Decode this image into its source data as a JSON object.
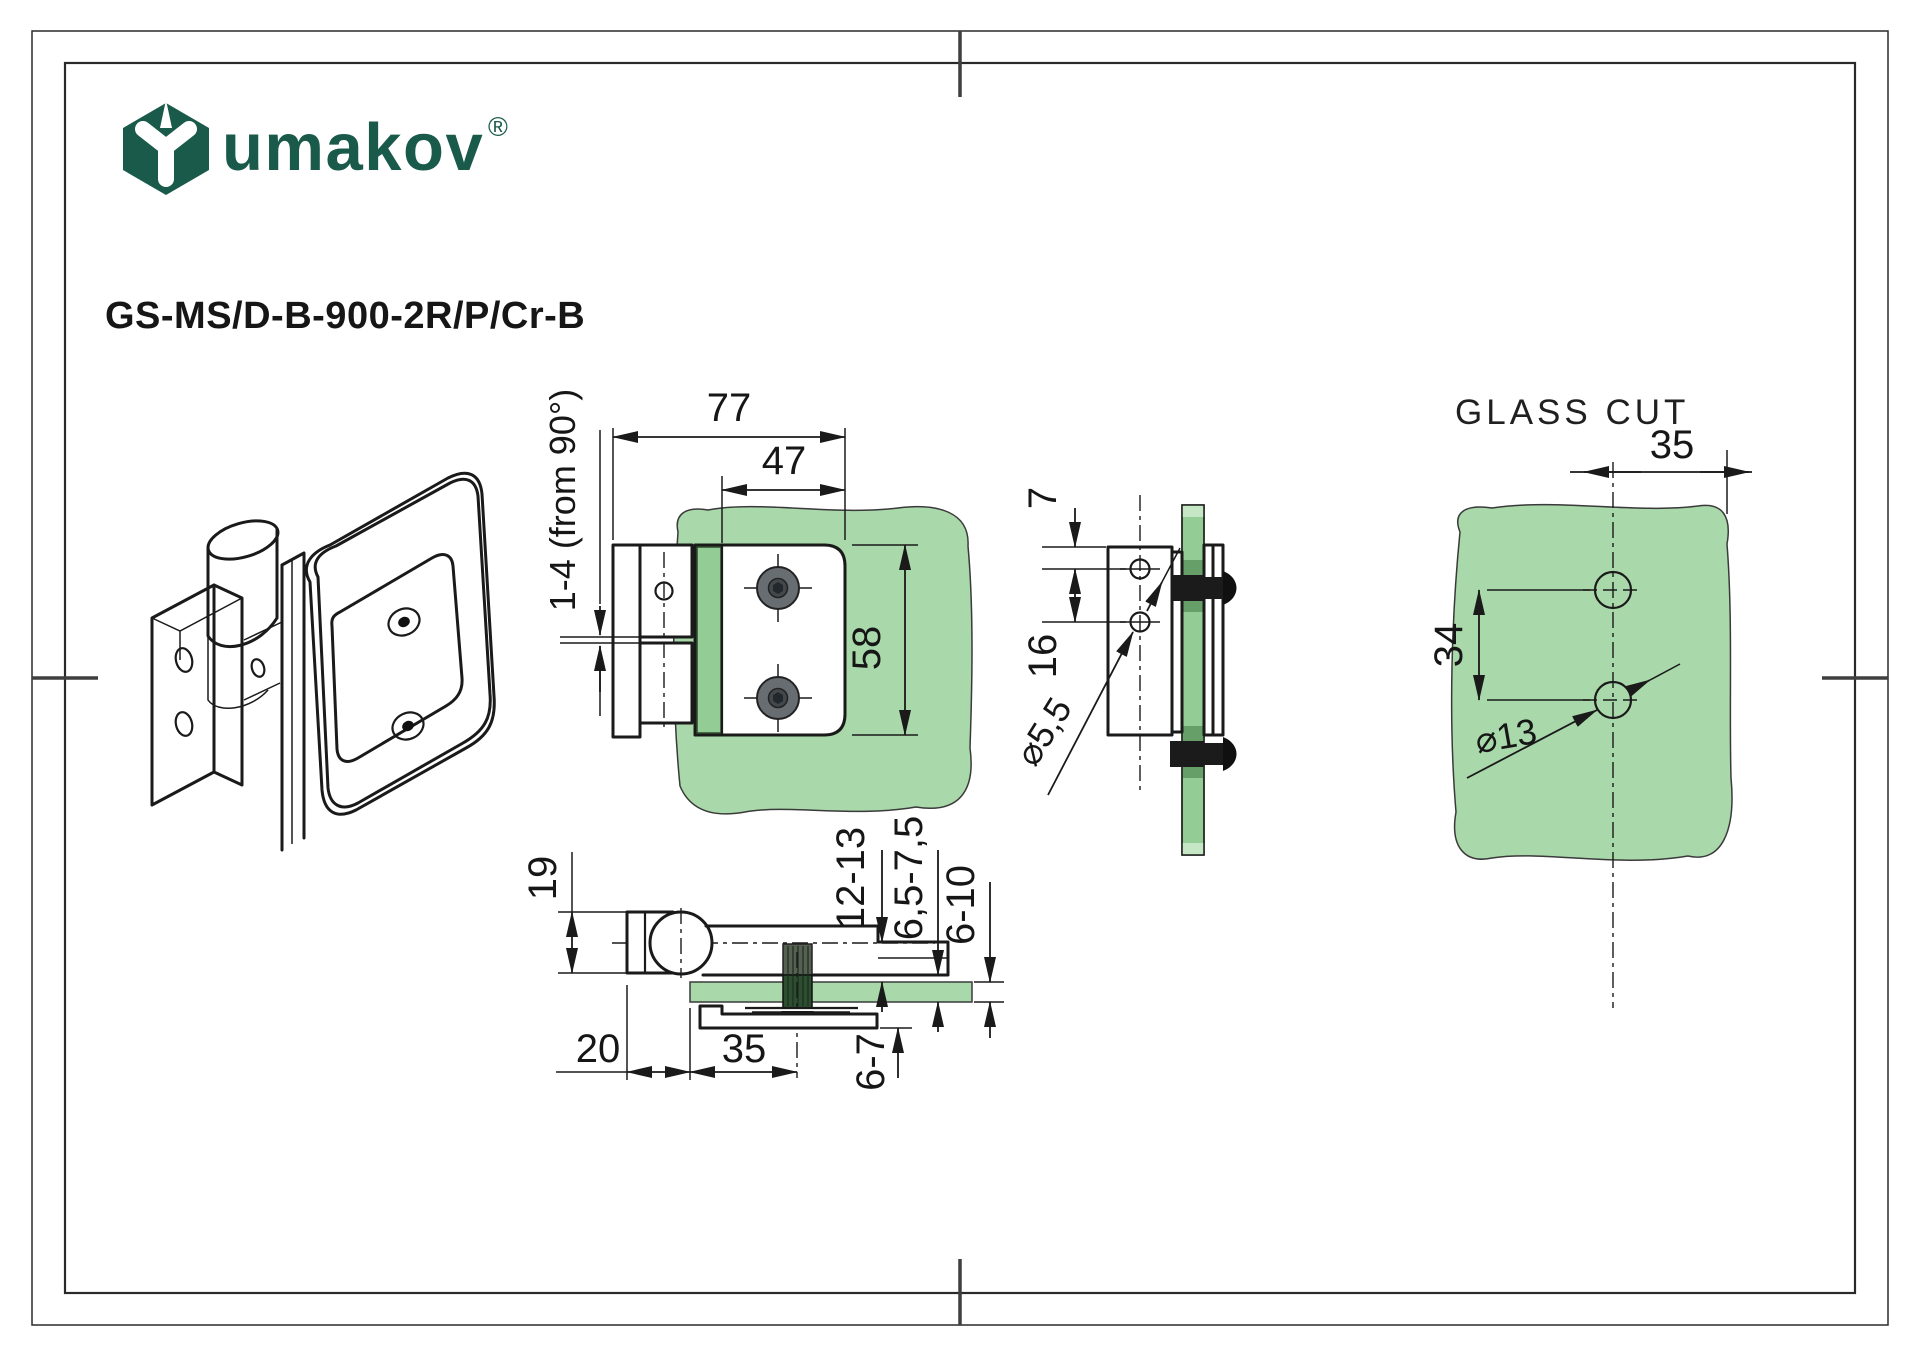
{
  "document": {
    "kind": "technical-drawing-sheet",
    "product": "glass door hinge"
  },
  "logo": {
    "icon": "umakov-hexagon-star-logo-icon",
    "brand": "umakov",
    "registered": "®"
  },
  "part_number": "GS-MS/D-B-900-2R/P/Cr-B",
  "views": {
    "front": {
      "dim_total_width": "77",
      "dim_plate_width": "47",
      "dim_height": "58",
      "dim_adjustment": "1-4 (from 90°)"
    },
    "side": {
      "dim_top_offset": "7",
      "dim_hole_spacing": "16",
      "dim_hole_diameter": "⌀5,5"
    },
    "bottom": {
      "dim_knuckle": "19",
      "dim_hinge_offset": "20",
      "dim_screw_offset": "35",
      "dim_clamp_height": "12-13",
      "dim_clamp_gap": "6,5-7,5",
      "dim_glass_thickness": "6-10",
      "dim_bottom_plate": "6-7"
    },
    "glass_cut": {
      "title": "GLASS CUT",
      "dim_hole_edge_offset": "35",
      "dim_hole_spacing": "34",
      "dim_hole_diameter": "⌀13"
    }
  },
  "colors": {
    "brand_green": "#1a5a4a",
    "glass_fill": "#a9d8aa",
    "glass_edge_fill": "#93cc95",
    "glass_dark_band": "#679f69",
    "glass_cap": "#c6e7c6",
    "screw_gray": "#686d71",
    "screw_dark": "#43484d",
    "line": "#1a1a1a"
  }
}
